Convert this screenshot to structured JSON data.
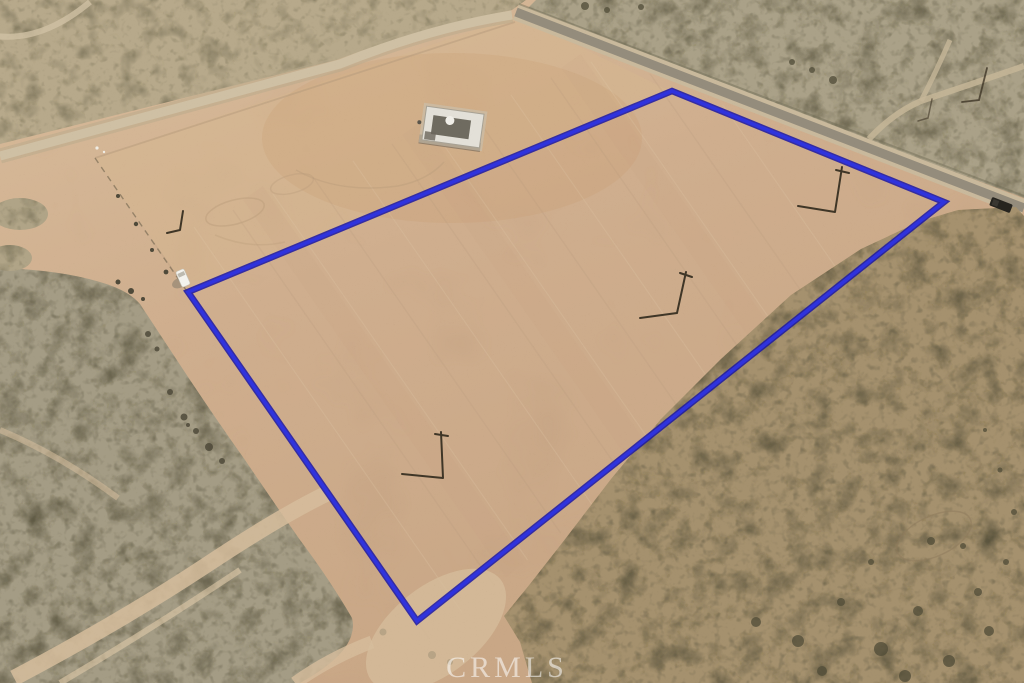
{
  "watermark": {
    "text": "CRMLS"
  },
  "boundary": {
    "points": "672,91 944,202 417,621 188,292",
    "color": "#2f33dd",
    "underlay_color": "#1a16a4"
  },
  "palette": {
    "terrain_base": "#cdb293",
    "parcel_strip": "#d6b78f",
    "building_tint": "#c89a6f",
    "scrub_northwest": "#b7a98b",
    "scrub_northeast": "#aaa188",
    "scrub_southeast": "#a5916e",
    "scrub_southwest": "#a49c85",
    "dirt_road": "#cfc0a4",
    "dirt_road_shoulder": "#b7a98c",
    "paved_road": "#948c7c",
    "paved_road_shoulder": "#c9b99c",
    "sand_trail": "#d6bd9c",
    "bush": "#4f4b37",
    "debris": "#4f4a3a",
    "pole": "#3f3627",
    "building_roof": "#e3e0d8",
    "vehicle_white": "#f4f3ee",
    "vehicle_dark": "#26241f"
  }
}
